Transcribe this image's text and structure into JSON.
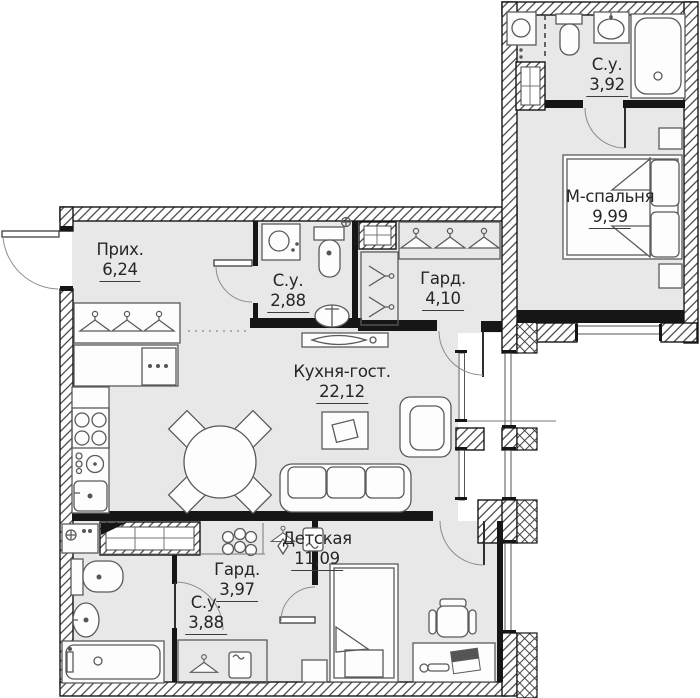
{
  "plan": {
    "type": "apartment-floor-plan",
    "rooms": [
      {
        "id": "hallway",
        "name": "Прих.",
        "area": "6,24"
      },
      {
        "id": "bathroom-hall",
        "name": "С.у.",
        "area": "2,88"
      },
      {
        "id": "wardrobe-hall",
        "name": "Гард.",
        "area": "4,10"
      },
      {
        "id": "bathroom-master",
        "name": "С.у.",
        "area": "3,92"
      },
      {
        "id": "master-bedroom",
        "name": "М-спальня",
        "area": "9,99"
      },
      {
        "id": "kitchen-living",
        "name": "Кухня-гост.",
        "area": "22,12"
      },
      {
        "id": "children-room",
        "name": "Детская",
        "area": "11,09"
      },
      {
        "id": "wardrobe-children",
        "name": "Гард.",
        "area": "3,97"
      },
      {
        "id": "bathroom-children",
        "name": "С.у.",
        "area": "3,88"
      }
    ],
    "colors": {
      "wall": "#161616",
      "room_fill": "#e8e8e8",
      "furniture_line": "#5a5a5a",
      "background": "#ffffff"
    },
    "icons": {
      "hanger-icon": "clothes hanger (triangle with hook)",
      "washing-machine-icon": "square with porthole circle",
      "stove-icon": "four burner circles",
      "sink-icon": "oval basin",
      "bathtub-icon": "rectangle with rounded inner rim and drain",
      "toilet-icon": "cistern with rounded bowl",
      "duct-icon": "hatched shaft box with grid",
      "bed-icon": "rectangle with pillows and folded blanket corner",
      "sofa-icon": "three seat cushions",
      "desk-chair-icon": "seat with armrests"
    }
  }
}
